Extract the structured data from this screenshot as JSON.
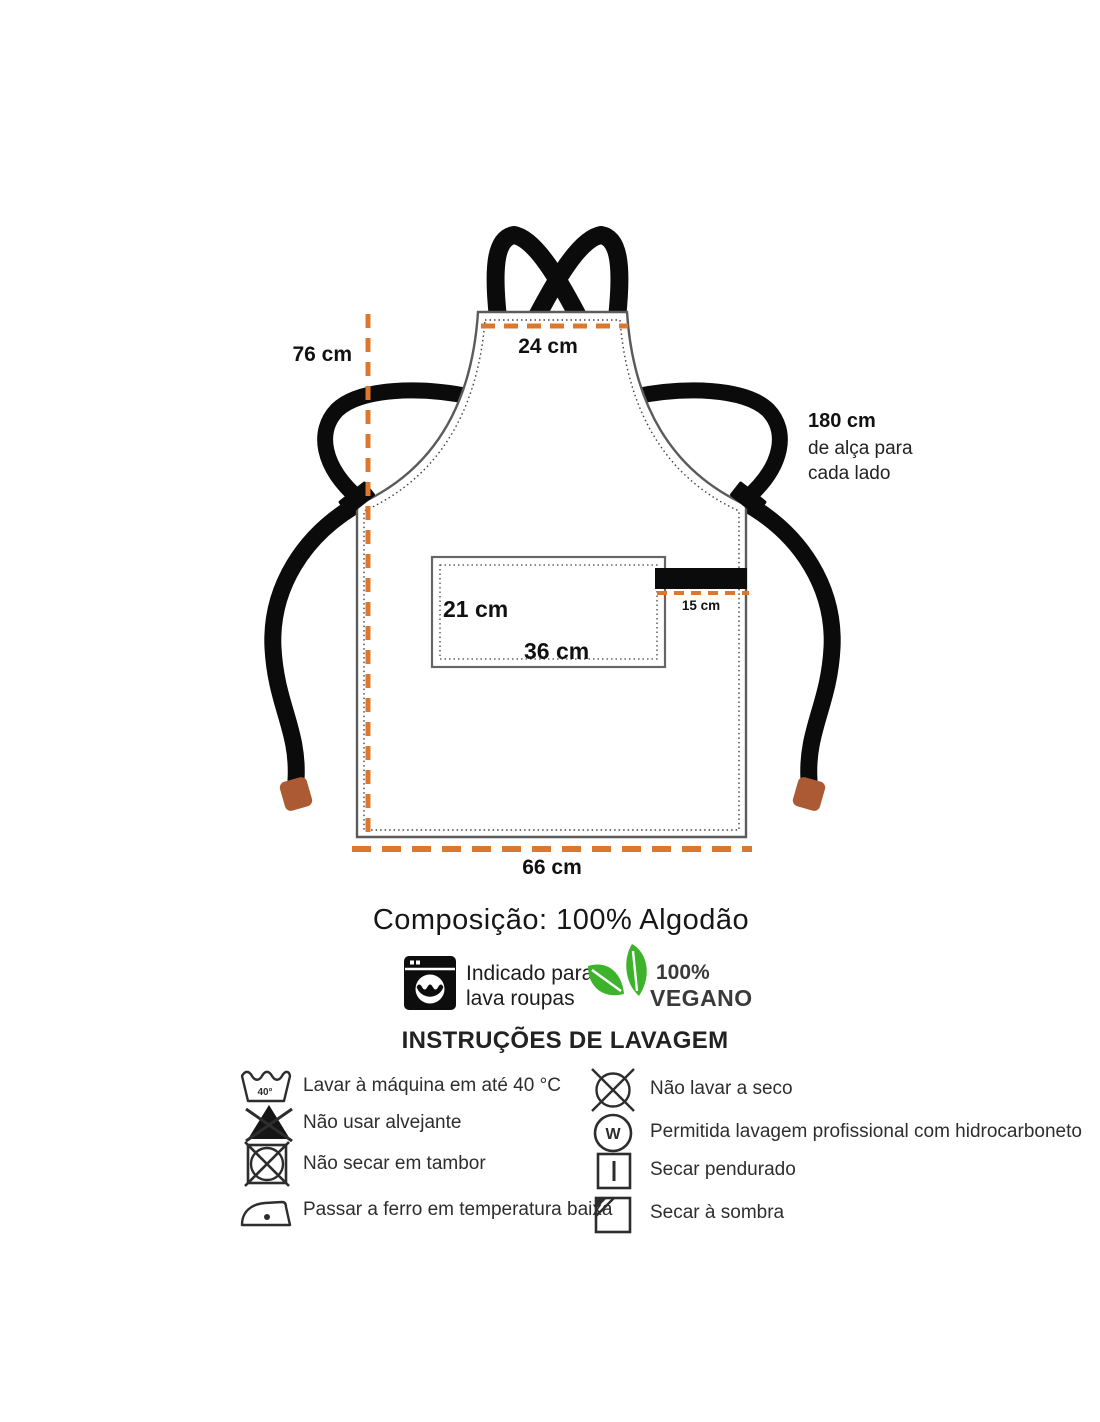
{
  "diagram": {
    "measurements": {
      "height": "76 cm",
      "top_width": "24 cm",
      "strap_length": "180 cm",
      "strap_note_line1": "de alça para",
      "strap_note_line2": "cada lado",
      "pocket_height": "21 cm",
      "pocket_width": "36 cm",
      "side_strap": "15 cm",
      "bottom_width": "66 cm"
    },
    "colors": {
      "dimension_line": "#DC782E",
      "strap": "#0B0B0B",
      "tie_tip": "#AC5A33",
      "outline": "#5B5B5B"
    }
  },
  "composition": {
    "text": "Composição: 100% Algodão"
  },
  "features": {
    "washer": {
      "icon": "washing-machine-icon",
      "label_line1": "Indicado para",
      "label_line2": "lava roupas"
    },
    "vegan": {
      "icon": "leaves-icon",
      "leaf_color": "#3DB32B",
      "percent": "100%",
      "label": "VEGANO"
    }
  },
  "care": {
    "title": "INSTRUÇÕES DE LAVAGEM",
    "left": [
      {
        "icon": "wash-40-icon",
        "temp": "40°",
        "label": "Lavar à máquina em até 40 °C"
      },
      {
        "icon": "no-bleach-icon",
        "label": "Não usar alvejante"
      },
      {
        "icon": "no-tumble-dry-icon",
        "label": "Não secar em tambor"
      },
      {
        "icon": "iron-low-icon",
        "label": "Passar a ferro em temperatura baixa"
      }
    ],
    "right": [
      {
        "icon": "no-dry-clean-icon",
        "label": "Não lavar a seco"
      },
      {
        "icon": "professional-clean-icon",
        "letter": "W",
        "label": "Permitida lavagem profissional com hidrocarboneto"
      },
      {
        "icon": "line-dry-icon",
        "label": "Secar pendurado"
      },
      {
        "icon": "dry-in-shade-icon",
        "label": "Secar à sombra"
      }
    ]
  }
}
